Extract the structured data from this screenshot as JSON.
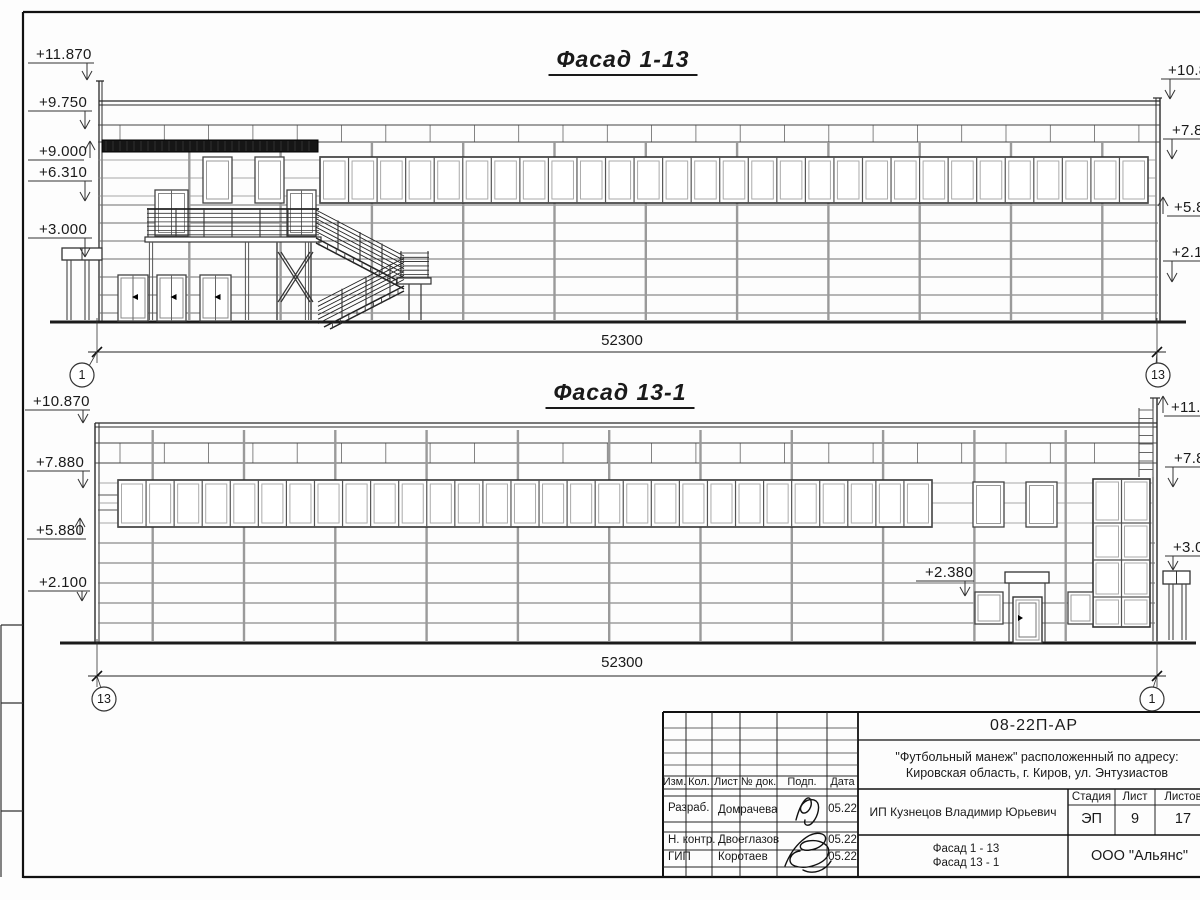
{
  "facade1": {
    "title": "Фасад 1-13",
    "dimension": "52300",
    "axis_bubbles": [
      {
        "label": "1",
        "cx": 82,
        "cy": 375
      },
      {
        "label": "13",
        "cx": 1158,
        "cy": 375
      }
    ],
    "dim_text": {
      "cx": 622,
      "y": 332
    },
    "title_pos": {
      "cx": 623,
      "y": 46
    },
    "marks": [
      {
        "label": "+11.870",
        "tx": 36,
        "ty": 46,
        "lx1": 28,
        "lx2": 94,
        "ly": 63,
        "ax": 87,
        "ay": 80,
        "dir": "down"
      },
      {
        "label": "+9.750",
        "tx": 39,
        "ty": 94,
        "lx1": 28,
        "lx2": 92,
        "ly": 111,
        "ax": 85,
        "ay": 129,
        "dir": "down"
      },
      {
        "label": "+9.000",
        "tx": 39,
        "ty": 143,
        "lx1": 28,
        "lx2": 84,
        "ly": 160,
        "ax": 90,
        "ay": 141,
        "dir": "up"
      },
      {
        "label": "+6.310",
        "tx": 39,
        "ty": 164,
        "lx1": 28,
        "lx2": 92,
        "ly": 181,
        "ax": 85,
        "ay": 201,
        "dir": "down"
      },
      {
        "label": "+3.000",
        "tx": 39,
        "ty": 221,
        "lx1": 28,
        "lx2": 92,
        "ly": 238,
        "ax": 85,
        "ay": 257,
        "dir": "down"
      },
      {
        "label": "+10.8",
        "tx": 1168,
        "ty": 62,
        "lx1": 1161,
        "lx2": 1204,
        "ly": 79,
        "ax": 1170,
        "ay": 99,
        "dir": "down"
      },
      {
        "label": "+7.8",
        "tx": 1172,
        "ty": 122,
        "lx1": 1163,
        "lx2": 1204,
        "ly": 139,
        "ax": 1172,
        "ay": 159,
        "dir": "down"
      },
      {
        "label": "+5.8",
        "tx": 1174,
        "ty": 199,
        "lx1": 1167,
        "lx2": 1204,
        "ly": 216,
        "ax": 1163,
        "ay": 197,
        "dir": "up"
      },
      {
        "label": "+2.1",
        "tx": 1172,
        "ty": 244,
        "lx1": 1163,
        "lx2": 1204,
        "ly": 261,
        "ax": 1172,
        "ay": 282,
        "dir": "down"
      }
    ]
  },
  "facade2": {
    "title": "Фасад 13-1",
    "dimension": "52300",
    "axis_bubbles": [
      {
        "label": "13",
        "cx": 104,
        "cy": 699
      },
      {
        "label": "1",
        "cx": 1152,
        "cy": 699
      }
    ],
    "dim_text": {
      "cx": 622,
      "y": 654
    },
    "title_pos": {
      "cx": 620,
      "y": 379
    },
    "marks": [
      {
        "label": "+10.870",
        "tx": 33,
        "ty": 393,
        "lx1": 25,
        "lx2": 90,
        "ly": 410,
        "ax": 83,
        "ay": 423,
        "dir": "down"
      },
      {
        "label": "+7.880",
        "tx": 36,
        "ty": 454,
        "lx1": 27,
        "lx2": 90,
        "ly": 471,
        "ax": 83,
        "ay": 488,
        "dir": "down"
      },
      {
        "label": "+5.880",
        "tx": 36,
        "ty": 522,
        "lx1": 27,
        "lx2": 86,
        "ly": 539,
        "ax": 80,
        "ay": 518,
        "dir": "up"
      },
      {
        "label": "+2.100",
        "tx": 39,
        "ty": 574,
        "lx1": 28,
        "lx2": 90,
        "ly": 591,
        "ax": 82,
        "ay": 601,
        "dir": "down"
      },
      {
        "label": "+11.8",
        "tx": 1171,
        "ty": 399,
        "lx1": 1164,
        "lx2": 1204,
        "ly": 416,
        "ax": 1163,
        "ay": 396,
        "dir": "up"
      },
      {
        "label": "+7.8",
        "tx": 1174,
        "ty": 450,
        "lx1": 1165,
        "lx2": 1204,
        "ly": 467,
        "ax": 1173,
        "ay": 487,
        "dir": "down"
      },
      {
        "label": "+3.0",
        "tx": 1173,
        "ty": 539,
        "lx1": 1165,
        "lx2": 1204,
        "ly": 556,
        "ax": 1173,
        "ay": 570,
        "dir": "down"
      }
    ],
    "note": {
      "label": "+2.380",
      "tx": 925,
      "ty": 564,
      "lx1": 916,
      "lx2": 974,
      "ly": 581,
      "ax": 965,
      "ay": 596,
      "dir": "down"
    }
  },
  "titleblock": {
    "code": "08-22П-АР",
    "project_line1": "\"Футбольный манеж\" расположенный по адресу:",
    "project_line2": "Кировская область, г. Киров, ул. Энтузиастов",
    "client": "ИП Кузнецов Владимир Юрьевич",
    "stage_label": "Стадия",
    "sheet_label": "Лист",
    "sheets_label": "Листов",
    "stage": "ЭП",
    "sheet_no": "9",
    "sheets_total": "17",
    "content_line1": "Фасад 1 - 13",
    "content_line2": "Фасад 13 - 1",
    "company": "ООО \"Альянс\"",
    "columns": [
      "Изм.",
      "Кол.",
      "Лист",
      "№ док.",
      "Подп.",
      "Дата"
    ],
    "rows": [
      {
        "role": "Разраб.",
        "name": "Домрачева",
        "date": "05.22"
      },
      {
        "role": "Н. контр.",
        "name": "Двоеглазов",
        "date": "05.22"
      },
      {
        "role": "ГИП",
        "name": "Коротаев",
        "date": "05.22"
      }
    ]
  }
}
